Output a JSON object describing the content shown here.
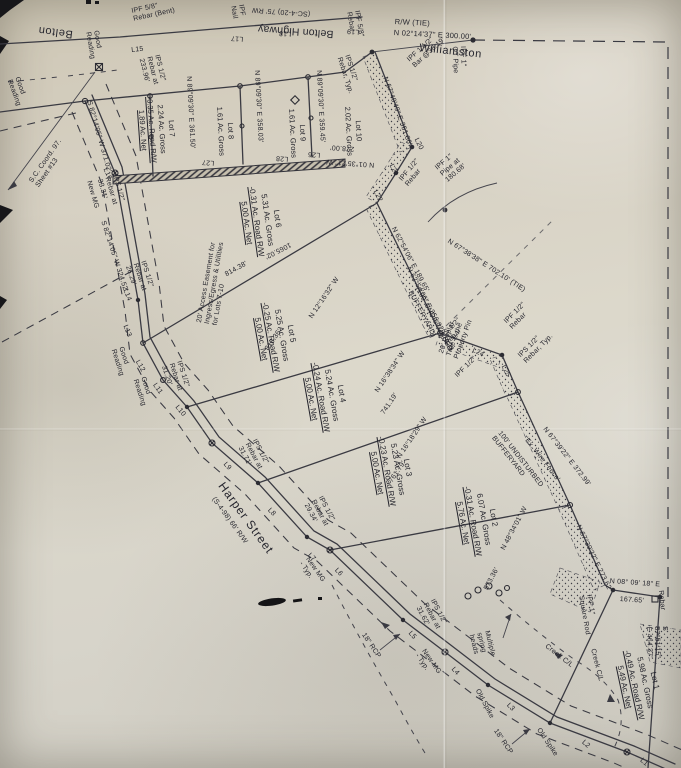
{
  "map": {
    "roads": {
      "belton": "Belton",
      "belton_highway": "Belton Highway",
      "belton_highway_rw": "(SC-4-20)  75' RW",
      "williamston": "Williamston",
      "harper_street": "Harper Street",
      "harper_street_rw": "(S-4-98)   66' R/W"
    },
    "lots": [
      {
        "name": "Lot 1",
        "gross": "5.98 Ac. Gross",
        "road": "-0.49 Ac. Road R/W",
        "net": "5.49 Ac. Net"
      },
      {
        "name": "Lot 2",
        "gross": "6.07 Ac. Gross",
        "road": "-0.31 Ac. Road R/W",
        "net": "5.76 Ac. Net"
      },
      {
        "name": "Lot 3",
        "gross": "5.23 Ac. Gross",
        "road": "-0.23 Ac. Road R/W",
        "net": "5.00 Ac. Net"
      },
      {
        "name": "Lot 4",
        "gross": "5.24 Ac. Gross",
        "road": "-0.24 Ac. Road R/W",
        "net": "5.00 Ac. Net"
      },
      {
        "name": "Lot 5",
        "gross": "5.25 Ac. Gross",
        "road": "-0.25 Ac. Road R/W",
        "net": "5.00 Ac. Net"
      },
      {
        "name": "Lot 6",
        "gross": "5.31 Ac. Gross",
        "road": "-0.31 Ac. Road R/W",
        "net": "5.00 Ac. Net"
      },
      {
        "name": "Lot 7",
        "gross": "2.24 Ac. Gross",
        "road": "-0.35 Ac. Road R/W",
        "net": "1.89 Ac. Net"
      },
      {
        "name": "Lot 8",
        "gross": "1.61 Ac. Gross"
      },
      {
        "name": "Lot 9",
        "gross": "1.61 Ac. Gross"
      },
      {
        "name": "Lot 10",
        "gross": "2.02 Ac. Gross"
      }
    ],
    "bearings": {
      "rw_tie": "R/W        (TIE)",
      "n02": "N 02°14'37\" E     300.00'",
      "n6740": "N 67°40'49\" E    351.86'",
      "n8930_361": "N 89°09'30\" E    361.50'",
      "n8930_358": "N 89°09'30\" E    358.03'",
      "n8930_359": "N 89°09'30\" E    359.45'",
      "n0135": "N 01°35'21\" W",
      "d278": "278.00'",
      "s82_371": "S 82°14'05\" W    371.02'",
      "s82_324": "S 82°14'05\" W    324.52'",
      "n6254_189": "N 62°54'06\" E    189.65'",
      "n6254_256": "N 62°54'06\" E    256.02'",
      "n6738_tie": "N 67°38'38\" E     702.10'   (TIE)",
      "n6739_372": "N 67°39'22\" E     372.99'",
      "n6739_273": "N 67°39'32\" E    273.62'",
      "n0809": "N 08° 09' 18\" E",
      "d16765": "167.65'",
      "s8751": "S 87°51'15\" E     464.37'",
      "n4834": "N 48°34'01\" W",
      "d57336": "573.36'",
      "n1216": "N 12°16'32\" W",
      "d81836": "818.36'",
      "n1638": "N 16°38'34\" W",
      "d74119": "741.19'",
      "n1618": "N 16°18'29\" W",
      "d76179": "761.79'",
      "d106502": "1065.02'",
      "d81438": "814.38'"
    },
    "markers": {
      "ipf58_rebar_bent": "IPF 5/8\"\nRebar (Bent)",
      "ipf_nail": "IPF\nNail",
      "ipf58_rebar": "IPF 5/8\"\nRebar",
      "ipf1_ot_pipe": "IPF 1\"\nOT Pipe",
      "ipf112_bar": "IPF 1 1/2\"\nBar @38.19'",
      "ips_rebar_typ": "IPS 1/2\"\nRebar, Typ.",
      "ips_rebar_233": "IPS 1/2\"\nRebar at\n233.96'",
      "ips_3331": "IPS 1/2\"\nRebar at\n33.31'",
      "ips_2629": "IPS 1/2\"\nRebar at\n26.29'",
      "ips_3120": "IPS 1/2\"\nRebar at\n31.20'",
      "ips_3171": "IPS 1/2\"\nRebar at\n31.71'",
      "ips_2934": "IPS 1/2\"\nRebar at\n29.34'",
      "ips_3162": "IPS 1/2\"\nRebar at\n31.62'",
      "ipf1_pipe_180": "IPF 1\"\nPipe at\n180.68'",
      "ipf12_rebar": "IPF 1/2\"\nRebar",
      "ips12_rebar": "IPS 1/2\"\nRebar",
      "ipf12": "IPF 1/2\"",
      "new_mg": "New MG",
      "new_mg_typ": "New MG\n- Typ.",
      "good_reading": "Good\nReading",
      "old_spike": "Old Spike",
      "rcp18": "18\" RCP",
      "square_rod": "IPF 1\"\nSquare Rod",
      "rebar": "Rebar"
    },
    "notes": {
      "access_easement": "20' Access Easement for\nIngress/Egress & Utilities\nfor Lots 7-10",
      "buffer": "100' UNDISTURBED\nBUFFERYARD",
      "buffer2": "(100' UNDISTURBED\nBUFFERYARD)",
      "ex_wire": "'Ex. Wire Fence'",
      "poplar": "20' Poplar\nTree is the\nProperty Pin",
      "springs": "Multiple\nspring\nheads",
      "creek": "Creek C/L",
      "sc_sheet": "S.C. Coord. 97.\nSheet #13"
    },
    "curve_labels": {
      "L1": "L1",
      "L2": "L2",
      "L3": "L3",
      "L4": "L4",
      "L5": "L5",
      "L6": "L6",
      "L7": "L7",
      "L8": "L8",
      "L9": "L9",
      "L10": "L10",
      "L11": "L11",
      "L12": "L12",
      "L13": "L13",
      "L14": "L14",
      "L15": "L15",
      "L16": "L16",
      "L17": "L17",
      "L18": "L18",
      "L19": "L19",
      "L20": "L20",
      "L21": "L21",
      "L22": "L22",
      "L23": "L23",
      "L24": "L24",
      "L25": "L25",
      "L26": "L26",
      "L27": "L27",
      "L28": "L28"
    }
  }
}
